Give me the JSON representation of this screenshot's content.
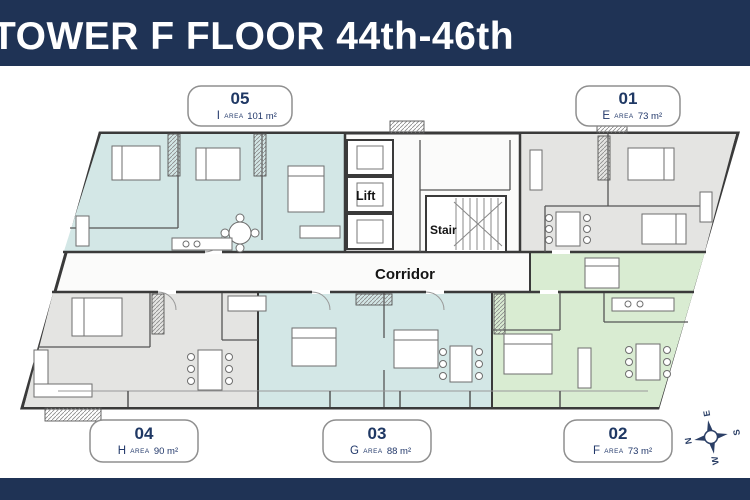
{
  "title_bar": {
    "title": "TOWER F FLOOR 44th-46th"
  },
  "plan": {
    "core": {
      "lift": "Lift",
      "stair": "Stair",
      "corridor": "Corridor"
    }
  },
  "labels": {
    "area": "AREA"
  },
  "badges": [
    {
      "number": "05",
      "letter": "I",
      "area": "101 m²"
    },
    {
      "number": "01",
      "letter": "E",
      "area": "73 m²"
    },
    {
      "number": "04",
      "letter": "H",
      "area": "90 m²"
    },
    {
      "number": "03",
      "letter": "G",
      "area": "88 m²"
    },
    {
      "number": "02",
      "letter": "F",
      "area": "73 m²"
    }
  ],
  "compass": {
    "n": "N",
    "e": "E",
    "s": "S",
    "w": "W"
  },
  "colors": {
    "navy": "#1f3355",
    "badge_text": "#1f3864",
    "unit_teal": "#d3e7e6",
    "unit_gray": "#e4e4e2",
    "unit_green": "#d9ecd2",
    "wall": "#3a3a3a"
  }
}
